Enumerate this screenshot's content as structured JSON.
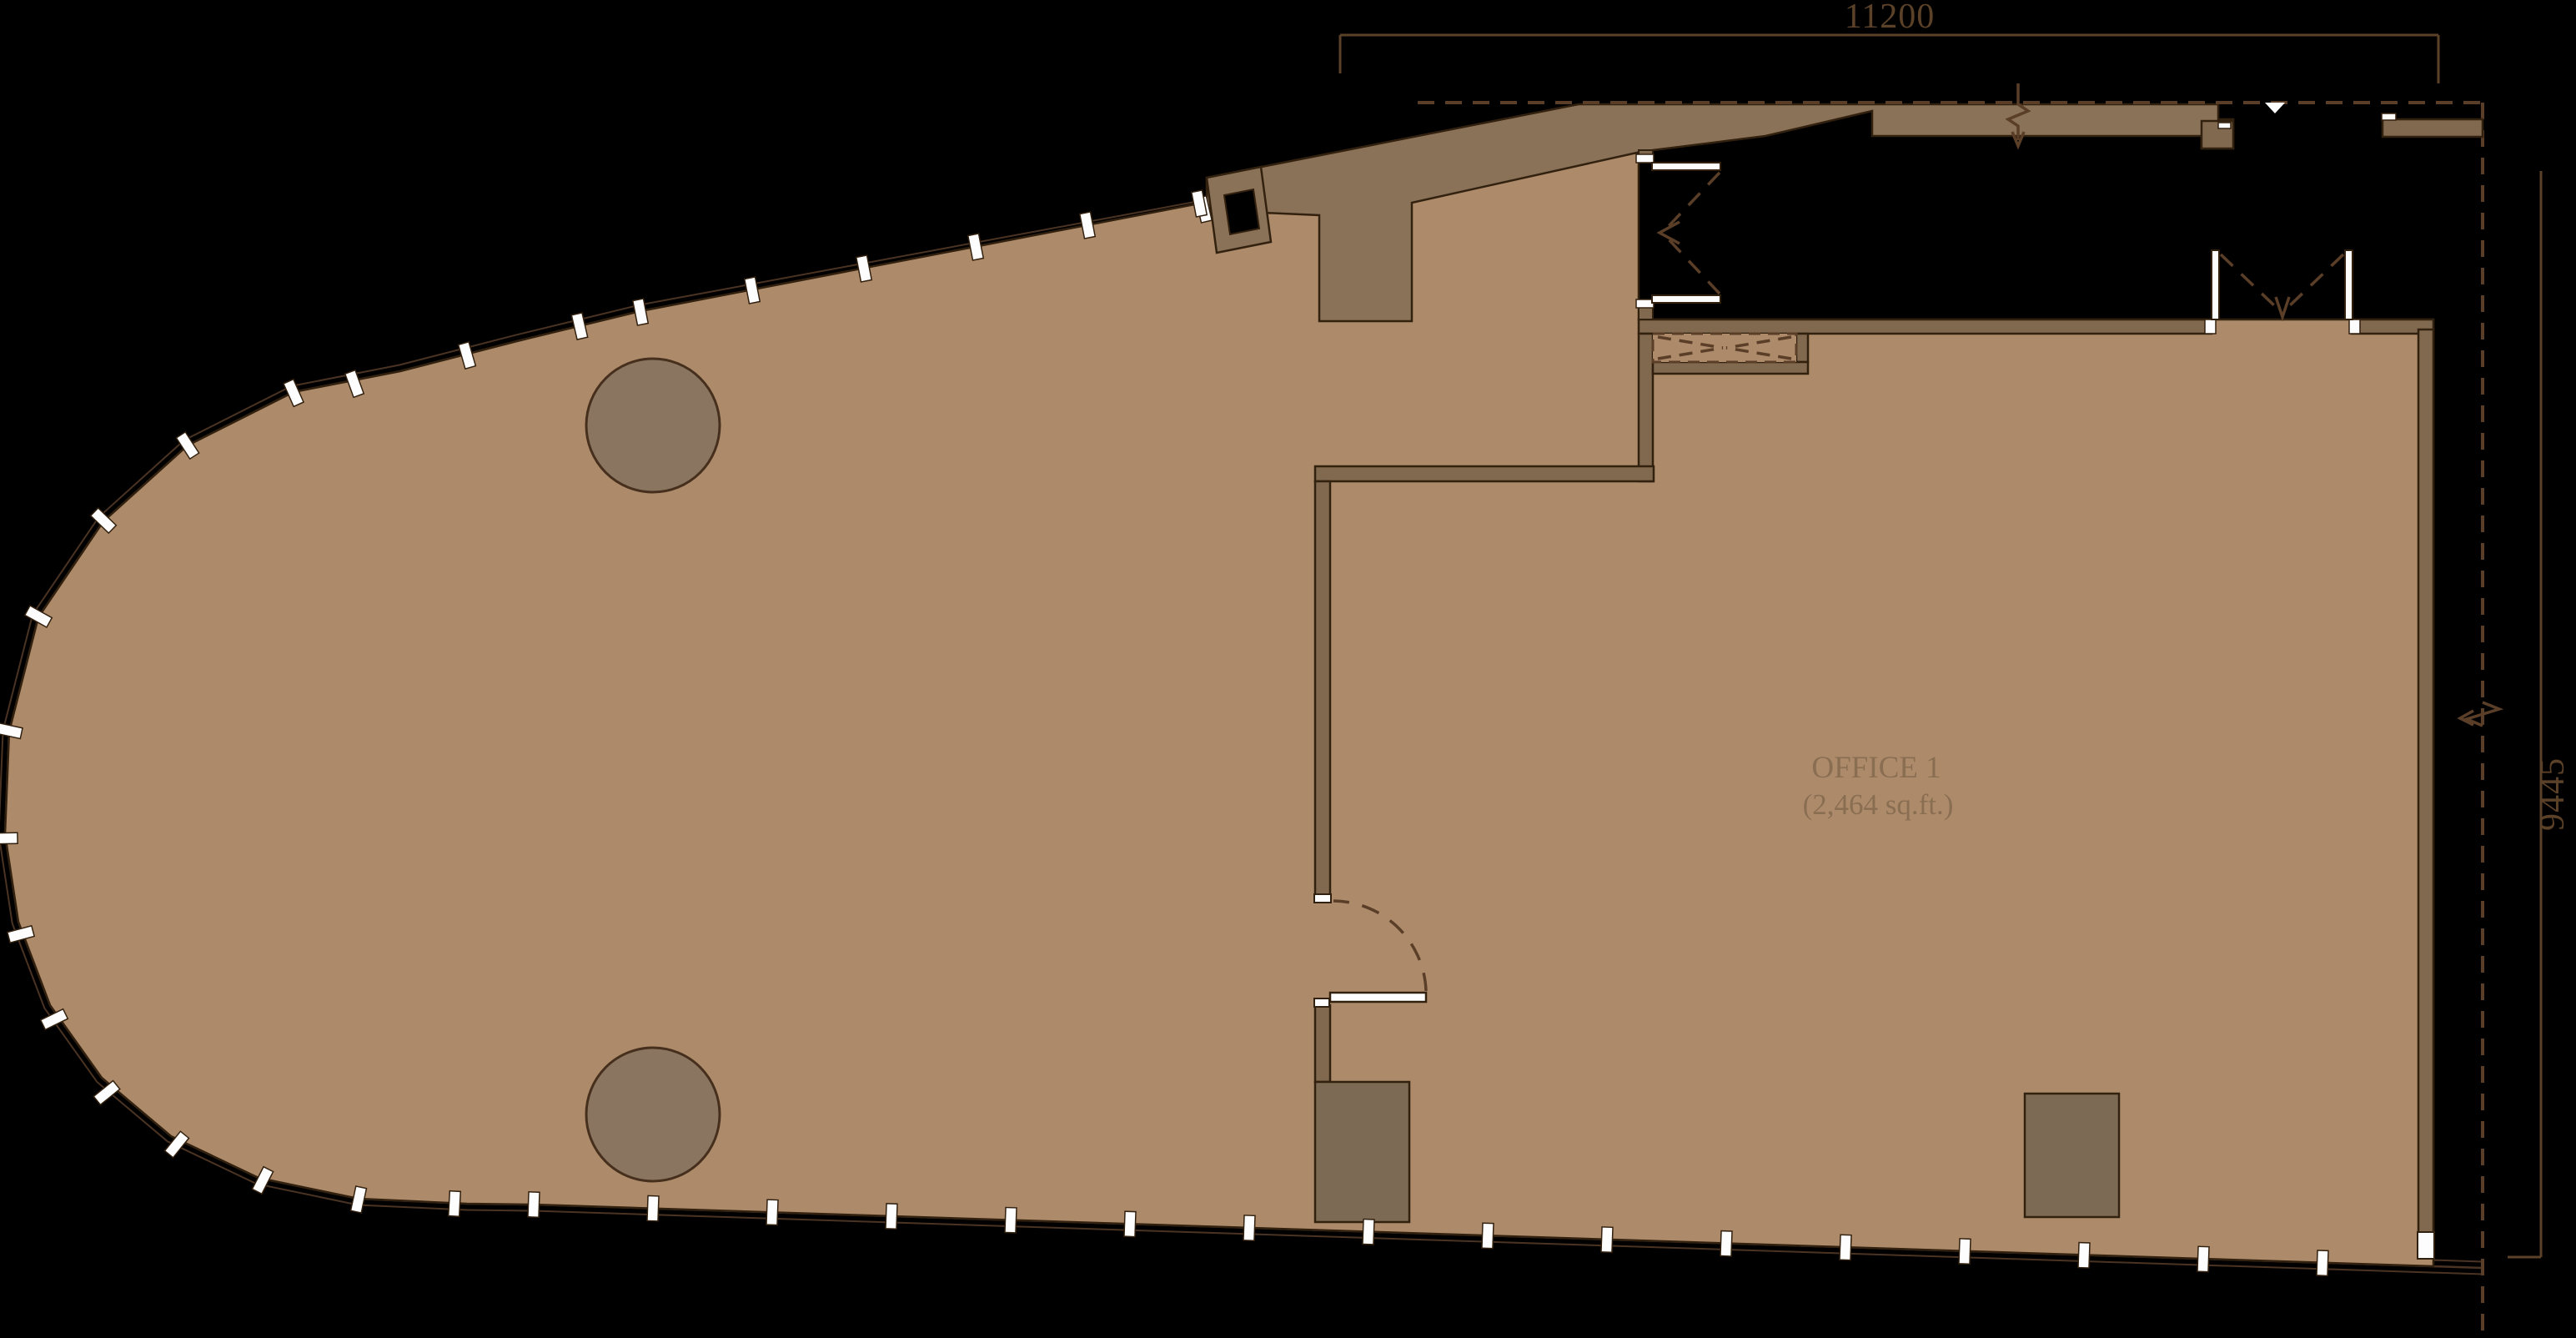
{
  "plan": {
    "room_label": {
      "name": "OFFICE 1",
      "area": "(2,464 sq.ft.)"
    },
    "dimensions": {
      "top_width": "11200",
      "right_height": "9445"
    }
  },
  "colors": {
    "background": "#000000",
    "floor": "#ad8b6a",
    "wall": "#80694f",
    "wall_light": "#8a7258",
    "column": "#8a7561",
    "block": "#7d6a55",
    "outline": "#33210f",
    "facade_line": "#4a3322",
    "dash_line": "#5a3e27",
    "dimension": "#5b4128",
    "label_text": "#8a6e52",
    "mullion": "#fdfdfd"
  }
}
